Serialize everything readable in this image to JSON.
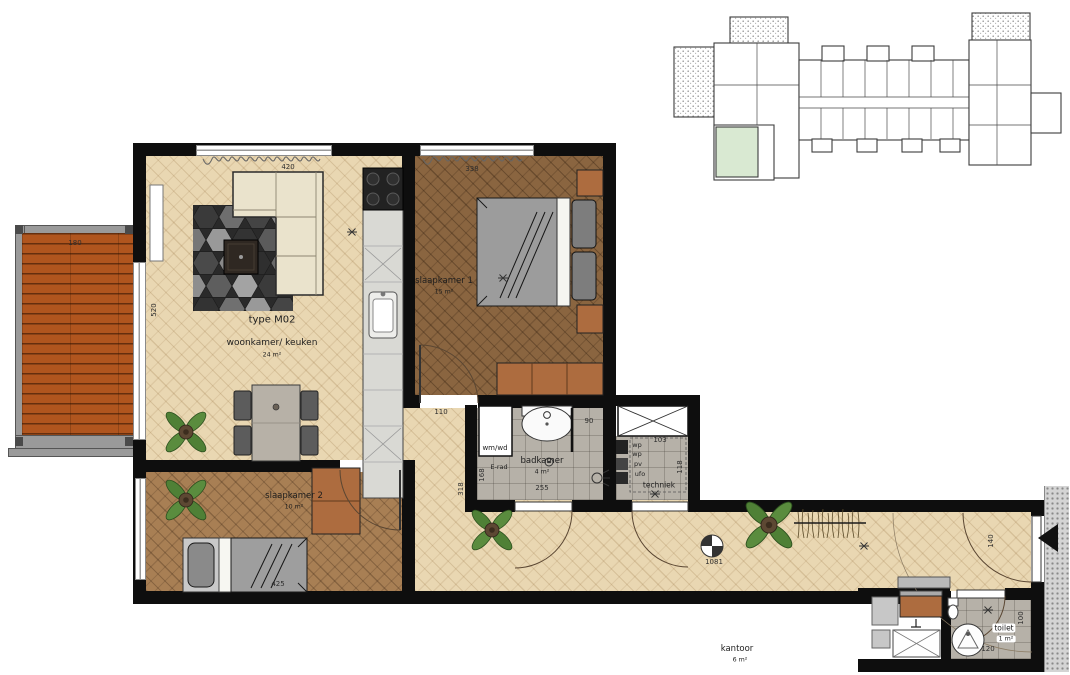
{
  "rooms": {
    "living": {
      "type_label": "type M02",
      "name": "woonkamer/ keuken",
      "area": "24 m²"
    },
    "bedroom1": {
      "name": "slaapkamer 1",
      "area": "15 m²"
    },
    "bedroom2": {
      "name": "slaapkamer 2",
      "area": "10 m²"
    },
    "bathroom": {
      "name": "badkamer",
      "area": "4 m²"
    },
    "technical": {
      "name": "techniek"
    },
    "toilet": {
      "name": "toilet",
      "area": "1 m²"
    },
    "office": {
      "name": "kantoor",
      "area": "6 m²"
    }
  },
  "fixtures": {
    "washer_dryer": "wm/wd",
    "electric_radiator": "E-rad",
    "heat_pump_1": "wp",
    "heat_pump_2": "wp",
    "pv_inverter": "pv",
    "vent_unit": "ufo"
  },
  "dimensions": {
    "living_width": "420",
    "bedroom1_width": "338",
    "balcony_width": "180",
    "living_height": "520",
    "hall_width": "110",
    "hall_depth": "318",
    "bath_top": "90",
    "bath_left": "168",
    "bath_bottom": "255",
    "tech_top": "103",
    "tech_right": "118",
    "corridor_length": "1081",
    "entry_width": "140",
    "toilet_depth": "100",
    "toilet_width": "120",
    "bed2_width": "425"
  },
  "colors": {
    "wall": "#0e0e0e",
    "wood_light": "#e9d7b2",
    "wood_dark": "#8a6540",
    "wood_mid": "#a87f54",
    "deck": "#b0551e",
    "tile": "#b6b1a8",
    "sofa": "#eae3cc",
    "brown": "#ad6c3f",
    "green_highlight": "#d9e9d2"
  }
}
